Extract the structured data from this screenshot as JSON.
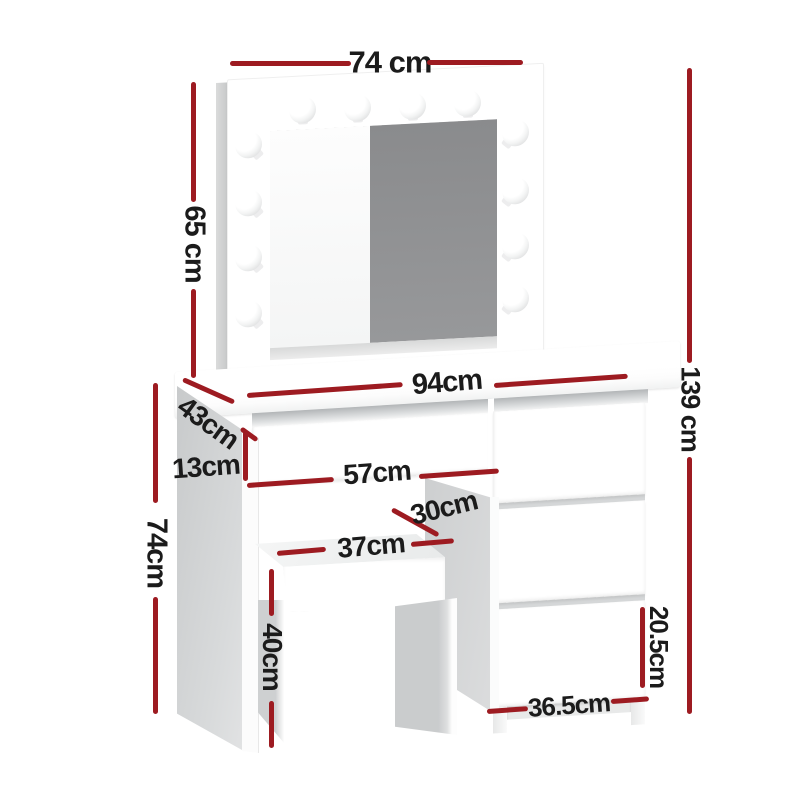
{
  "diagram": {
    "type": "product-dimension-diagram",
    "subject": "dressing table set with hollywood mirror, drawers and stool",
    "colors": {
      "background": "#ffffff",
      "dimension_line": "#9d1b21",
      "dimension_text": "#1b1b1b",
      "mirror_glass_gray": "#8f9092",
      "panel_shade_gray": "#cdcfd0",
      "furniture": "#ffffff"
    },
    "dimensions": [
      {
        "id": "mirror-width",
        "label": "74 cm"
      },
      {
        "id": "mirror-height",
        "label": "65 cm"
      },
      {
        "id": "tabletop-width",
        "label": "94cm"
      },
      {
        "id": "tabletop-depth",
        "label": "43cm"
      },
      {
        "id": "drawer-face-height",
        "label": "13cm"
      },
      {
        "id": "knee-drawer-width",
        "label": "57cm"
      },
      {
        "id": "stool-depth",
        "label": "30cm"
      },
      {
        "id": "stool-width",
        "label": "37cm"
      },
      {
        "id": "stool-height",
        "label": "40cm"
      },
      {
        "id": "table-height",
        "label": "74cm"
      },
      {
        "id": "total-height",
        "label": "139 cm"
      },
      {
        "id": "side-drawer-height",
        "label": "20.5cm"
      },
      {
        "id": "side-drawer-width",
        "label": "36.5cm"
      }
    ]
  }
}
